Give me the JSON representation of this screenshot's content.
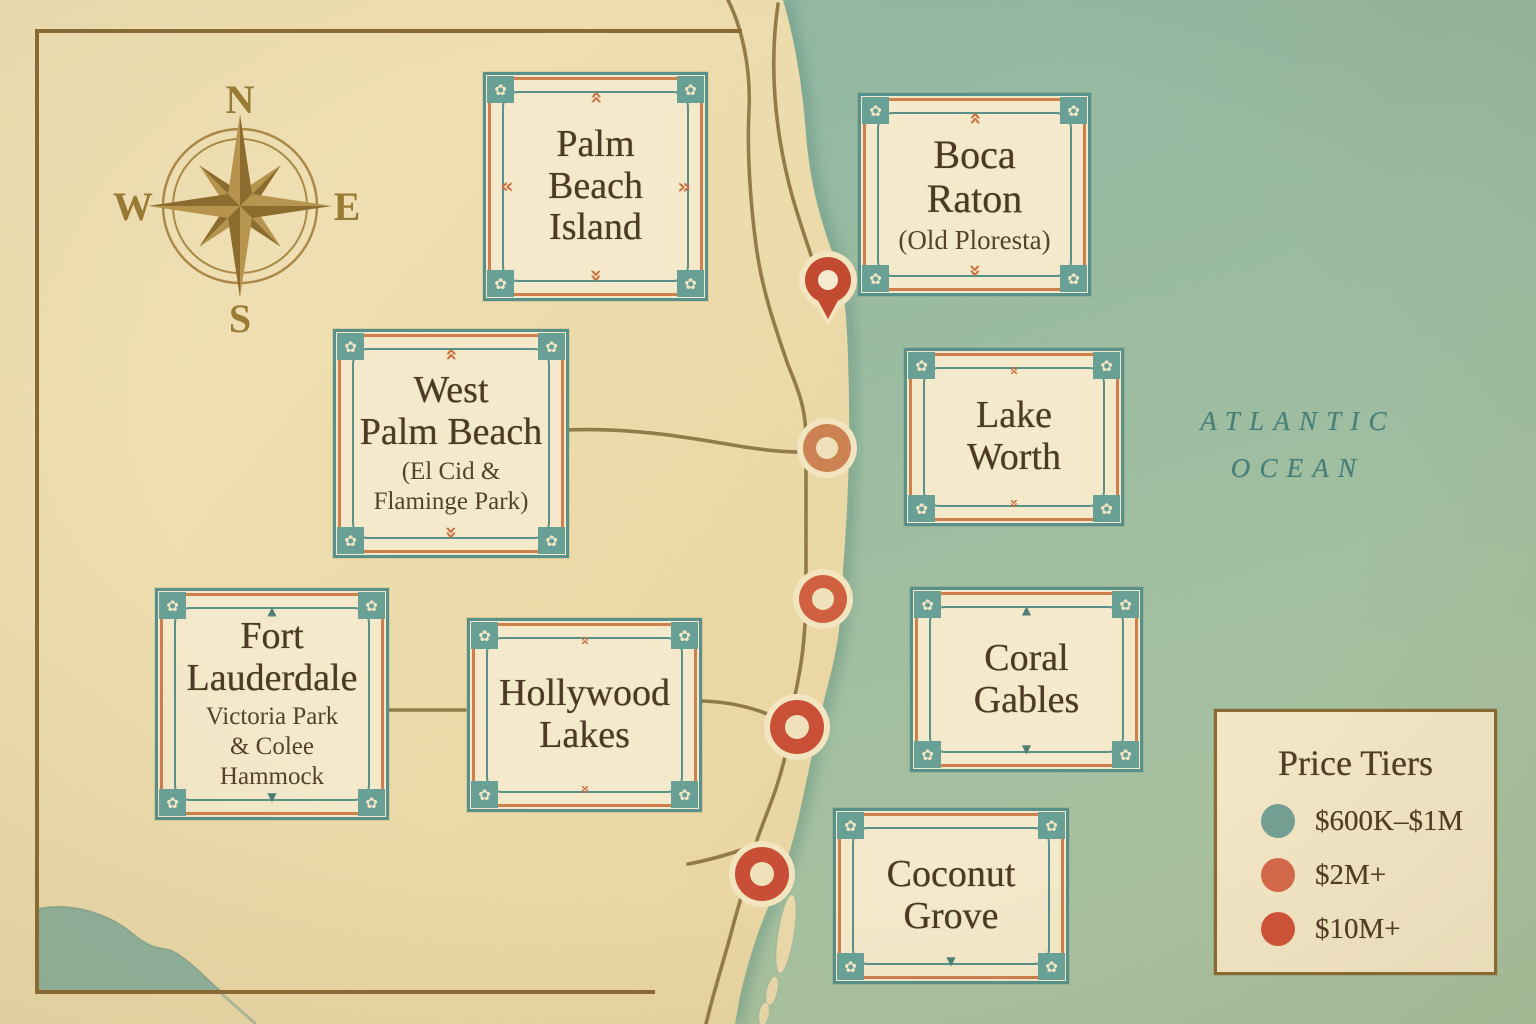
{
  "palette": {
    "land": "#eedcae",
    "ocean_top": "#8cb6a4",
    "ocean_bottom": "#a8c2a0",
    "box_fill": "#f4e9ca",
    "teal_border": "#57918a",
    "orange_border": "#cd7f4c",
    "text_brown": "#4c3a24",
    "road": "#8b7340",
    "frame": "#8a6a33",
    "compass_gold": "#a3813b",
    "ocean_text": "#47807a",
    "halo": "#f3e6c1"
  },
  "icons": {
    "chevron": "»",
    "triangle_up": "▲",
    "triangle_down": "▼",
    "flower": "✿"
  },
  "compass": {
    "n": "N",
    "e": "E",
    "s": "S",
    "w": "W"
  },
  "ocean_label": "ATLANTIC\nOCEAN",
  "regions": [
    {
      "id": "palm-beach-island",
      "title": "Palm\nBeach\nIsland",
      "subtitle": ""
    },
    {
      "id": "boca-raton",
      "title": "Boca\nRaton",
      "subtitle": "(Old Ploresta)"
    },
    {
      "id": "west-palm-beach",
      "title": "West\nPalm Beach",
      "subtitle": "(El Cid &\nFlaminge Park)"
    },
    {
      "id": "lake-worth",
      "title": "Lake\nWorth",
      "subtitle": ""
    },
    {
      "id": "fort-lauderdale",
      "title": "Fort\nLauderdale",
      "subtitle": "Victoria Park\n& Colee Hammock"
    },
    {
      "id": "hollywood-lakes",
      "title": "Hollywood\nLakes",
      "subtitle": ""
    },
    {
      "id": "coral-gables",
      "title": "Coral\nGables",
      "subtitle": ""
    },
    {
      "id": "coconut-grove",
      "title": "Coconut\nGrove",
      "subtitle": ""
    }
  ],
  "legend": {
    "title": "Price Tiers",
    "items": [
      {
        "label": "$600K–$1M",
        "color": "#74a095"
      },
      {
        "label": "$2M+",
        "color": "#d4694a"
      },
      {
        "label": "$10M+",
        "color": "#cf5138"
      }
    ]
  },
  "markers": [
    {
      "shape": "pin",
      "tier": "$10M+",
      "color": "#c2492f",
      "x": 828,
      "y": 280
    },
    {
      "shape": "ring",
      "tier": "$2M+",
      "color": "#cd8252",
      "x": 827,
      "y": 448,
      "r": 24
    },
    {
      "shape": "ring",
      "tier": "$2M+",
      "color": "#d0603f",
      "x": 823,
      "y": 599,
      "r": 24
    },
    {
      "shape": "ring",
      "tier": "$10M+",
      "color": "#ca4f35",
      "x": 797,
      "y": 727,
      "r": 27
    },
    {
      "shape": "ring",
      "tier": "$10M+",
      "color": "#c94e35",
      "x": 762,
      "y": 874,
      "r": 27
    }
  ]
}
